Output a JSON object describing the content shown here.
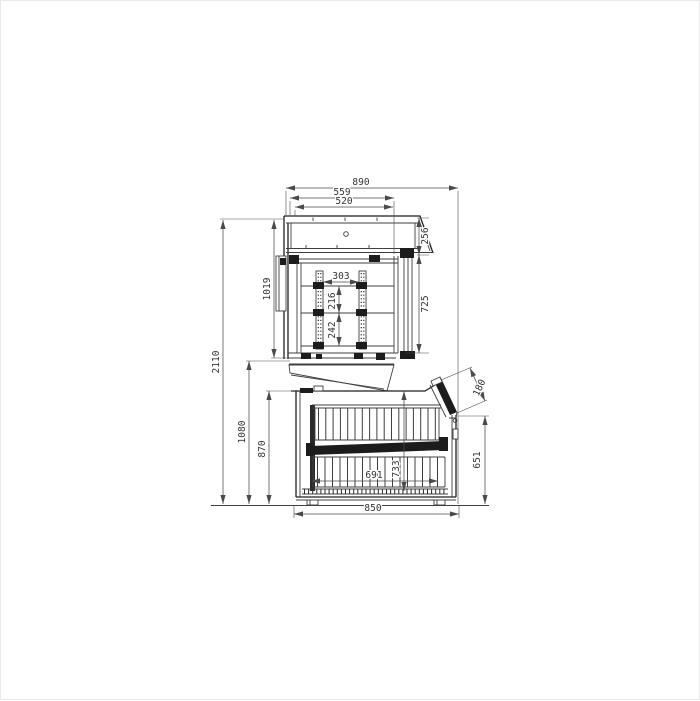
{
  "drawing": {
    "kind": "technical-dimension-drawing",
    "views": "side-elevation, upper display unit stacked above chest unit"
  },
  "dims": {
    "overall_depth": "890",
    "canopy_outer_depth": "559",
    "canopy_inner_depth": "520",
    "canopy_front_height": "256",
    "glass_door_height": "725",
    "upper_unit_height": "1019",
    "shelf_clear_depth": "303",
    "shelf_gap_upper": "216",
    "shelf_gap_lower": "242",
    "overall_height": "2110",
    "lower_section_height": "1080",
    "chest_height": "870",
    "lid_glass_width": "180",
    "front_panel_height": "651",
    "chest_inner_height": "733",
    "chest_inner_depth": "691",
    "chest_base_depth": "850"
  }
}
